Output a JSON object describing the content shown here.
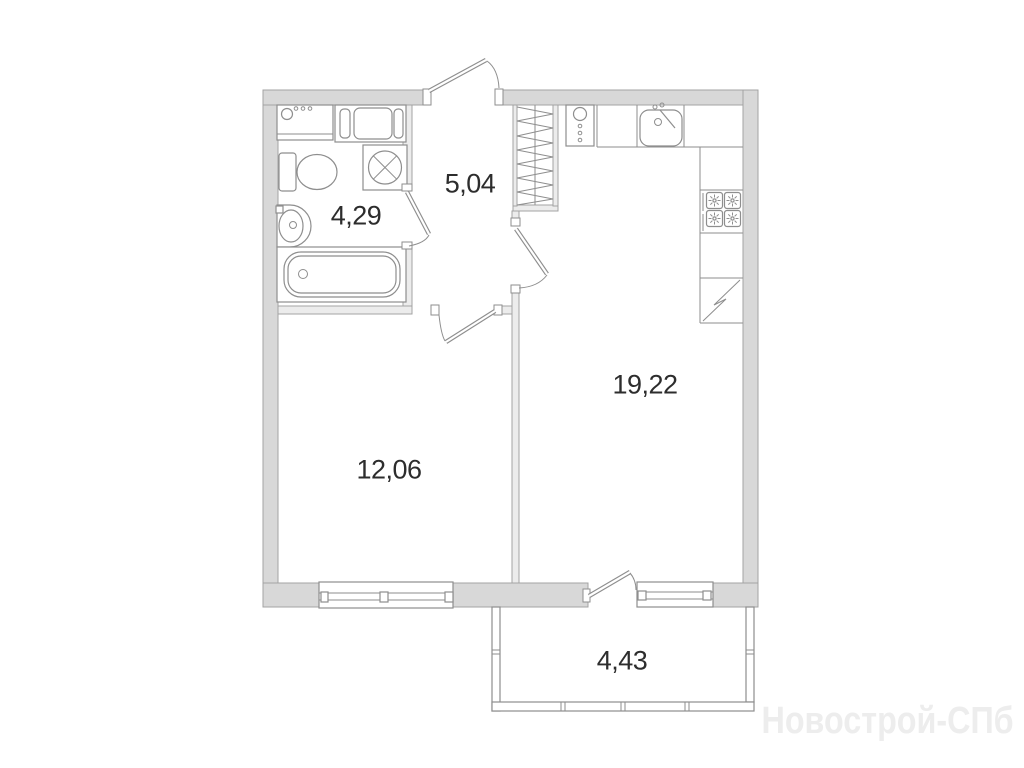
{
  "floor_plan": {
    "rooms": [
      {
        "name": "bathroom",
        "area": "4,29"
      },
      {
        "name": "hallway",
        "area": "5,04"
      },
      {
        "name": "living-room",
        "area": "12,06"
      },
      {
        "name": "kitchen",
        "area": "19,22"
      },
      {
        "name": "balcony",
        "area": "4,43"
      }
    ],
    "watermark": "Новострой-СПб",
    "fixtures": [
      "entrance-door",
      "bathroom-door",
      "living-room-door",
      "kitchen-door",
      "balcony-door",
      "wardrobe",
      "washing-machine",
      "bathroom-cabinet",
      "ventilation-unit",
      "toilet",
      "wash-basin",
      "bathtub",
      "oven-column",
      "kitchen-sink",
      "stove",
      "corner-cabinet",
      "living-room-window",
      "kitchen-window",
      "balcony-glazing"
    ]
  },
  "colors": {
    "background": "#ffffff",
    "wall_fill": "#d8d8d8",
    "wall_edge": "#a3a3a3",
    "inner_wall_fill": "#ececec",
    "fixture_line": "#8e8e8e",
    "label_text": "#2d2d2d",
    "watermark_text": "#ededed"
  }
}
